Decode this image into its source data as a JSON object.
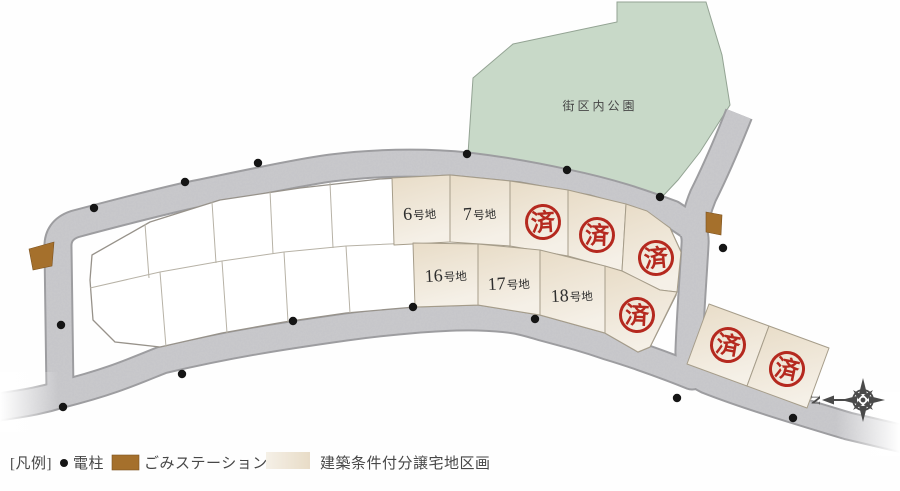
{
  "park": {
    "label": "街区内公園"
  },
  "plots": {
    "available": [
      {
        "num": "6",
        "suffix": "号地"
      },
      {
        "num": "7",
        "suffix": "号地"
      },
      {
        "num": "16",
        "suffix": "号地"
      },
      {
        "num": "17",
        "suffix": "号地"
      },
      {
        "num": "18",
        "suffix": "号地"
      }
    ],
    "sold_stamp": "済"
  },
  "compass": {
    "north": "N"
  },
  "legend": {
    "title": "[凡例]",
    "items": [
      {
        "key": "pole",
        "icon": "black-dot-icon",
        "label": "電柱"
      },
      {
        "key": "garbage",
        "icon": "brown-swatch-icon",
        "label": "ごみステーション"
      },
      {
        "key": "parcel",
        "icon": "beige-swatch-icon",
        "label": "建築条件付分譲宅地区画"
      }
    ]
  },
  "colors": {
    "park": "#c8d9c8",
    "park_line": "#93a393",
    "road": "#c9c9cc",
    "road_edge": "#9d9da0",
    "block_line": "#97928a",
    "divider": "#b7b2a6",
    "parcel_hi": "#f5f0e7",
    "parcel_lo": "#e8dcc7",
    "parcel_border": "#a69d8a",
    "stamp": "#b5291f",
    "brown": "#a5702c",
    "dot": "#151515",
    "text": "#474747",
    "label": "#2e2e2e",
    "compass": "#4a4a4a"
  }
}
